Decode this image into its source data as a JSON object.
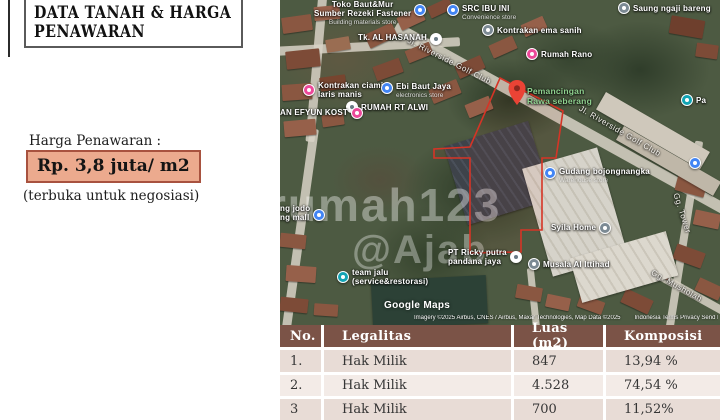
{
  "left_panel": {
    "title_line1": "DATA TANAH & HARGA",
    "title_line2": "PENAWARAN",
    "price_label": "Harga Penawaran :",
    "price_value": "Rp. 3,8 juta/ m2",
    "price_note": "(terbuka untuk negosiasi)"
  },
  "map": {
    "pin_label": {
      "line1": "Pemancingan",
      "line2": "Rawa seberang"
    },
    "streets": {
      "riverside1": "Jl. Riverside Golf Club",
      "riverside2": "Jl. Riverside Golf Club",
      "gg_tower": "Gg. Tower",
      "gg_musholah": "Gg. Musholah"
    },
    "pois": [
      {
        "line1": "Toko Baut&Mur",
        "line2": "Sumber Rezeki Fastener",
        "sub": "Building materials store"
      },
      {
        "line1": "SRC IBU INI",
        "sub": "Convenience store"
      },
      {
        "line1": "Tk. AL HASANAH"
      },
      {
        "line1": "Saung ngaji bareng"
      },
      {
        "line1": "Kontrakan ema sanih"
      },
      {
        "line1": "Rumah Rano"
      },
      {
        "line1": "Kontrakan ciamis",
        "line2": "laris manis"
      },
      {
        "line1": "Ebi Baut Jaya",
        "sub": "electronics store"
      },
      {
        "line1": "RUMAH RT ALWI"
      },
      {
        "line1": "AN EFYUN KOST"
      },
      {
        "line1": "Gudang bojongnangka",
        "sub": "Warehouse store"
      },
      {
        "line1": "Syila Home"
      },
      {
        "line1": "PT Ricky putra",
        "line2": "pandana jaya"
      },
      {
        "line1": "Musala Al Ittihad"
      },
      {
        "line1": "team jalu",
        "line2": "(service&restorasi)"
      },
      {
        "line1": "ng jodo",
        "line2": "ng mall"
      },
      {
        "line1": "Pa"
      }
    ],
    "watermark": {
      "line1": "rumah123",
      "line2": "@Ajab"
    },
    "logo": "Google Maps",
    "attribution_credits": "Imagery ©2025 Airbus, CNES / Airbus, Maxar Technologies, Map Data ©2025",
    "attribution_links": "Indonesia   Terms   Privacy   Send Product Feedback"
  },
  "table": {
    "columns": [
      "No.",
      "Legalitas",
      "Luas (m2)",
      "Komposisi"
    ],
    "rows": [
      [
        "1.",
        "Hak Milik",
        "847",
        "13,94 %"
      ],
      [
        "2.",
        "Hak Milik",
        "4.528",
        "74,54 %"
      ],
      [
        "3",
        "Hak Milik",
        "700",
        "11,52%"
      ]
    ]
  },
  "colors": {
    "table_header_bg": "#7b5347",
    "table_row_odd": "#e8dcd6",
    "table_row_even": "#f3ebe7",
    "price_fill": "#ecaa8e",
    "price_border": "#a8523f",
    "boundary_red": "#d63426",
    "pin_red": "#ea4335",
    "poi_green_label": "#8fd18f"
  }
}
